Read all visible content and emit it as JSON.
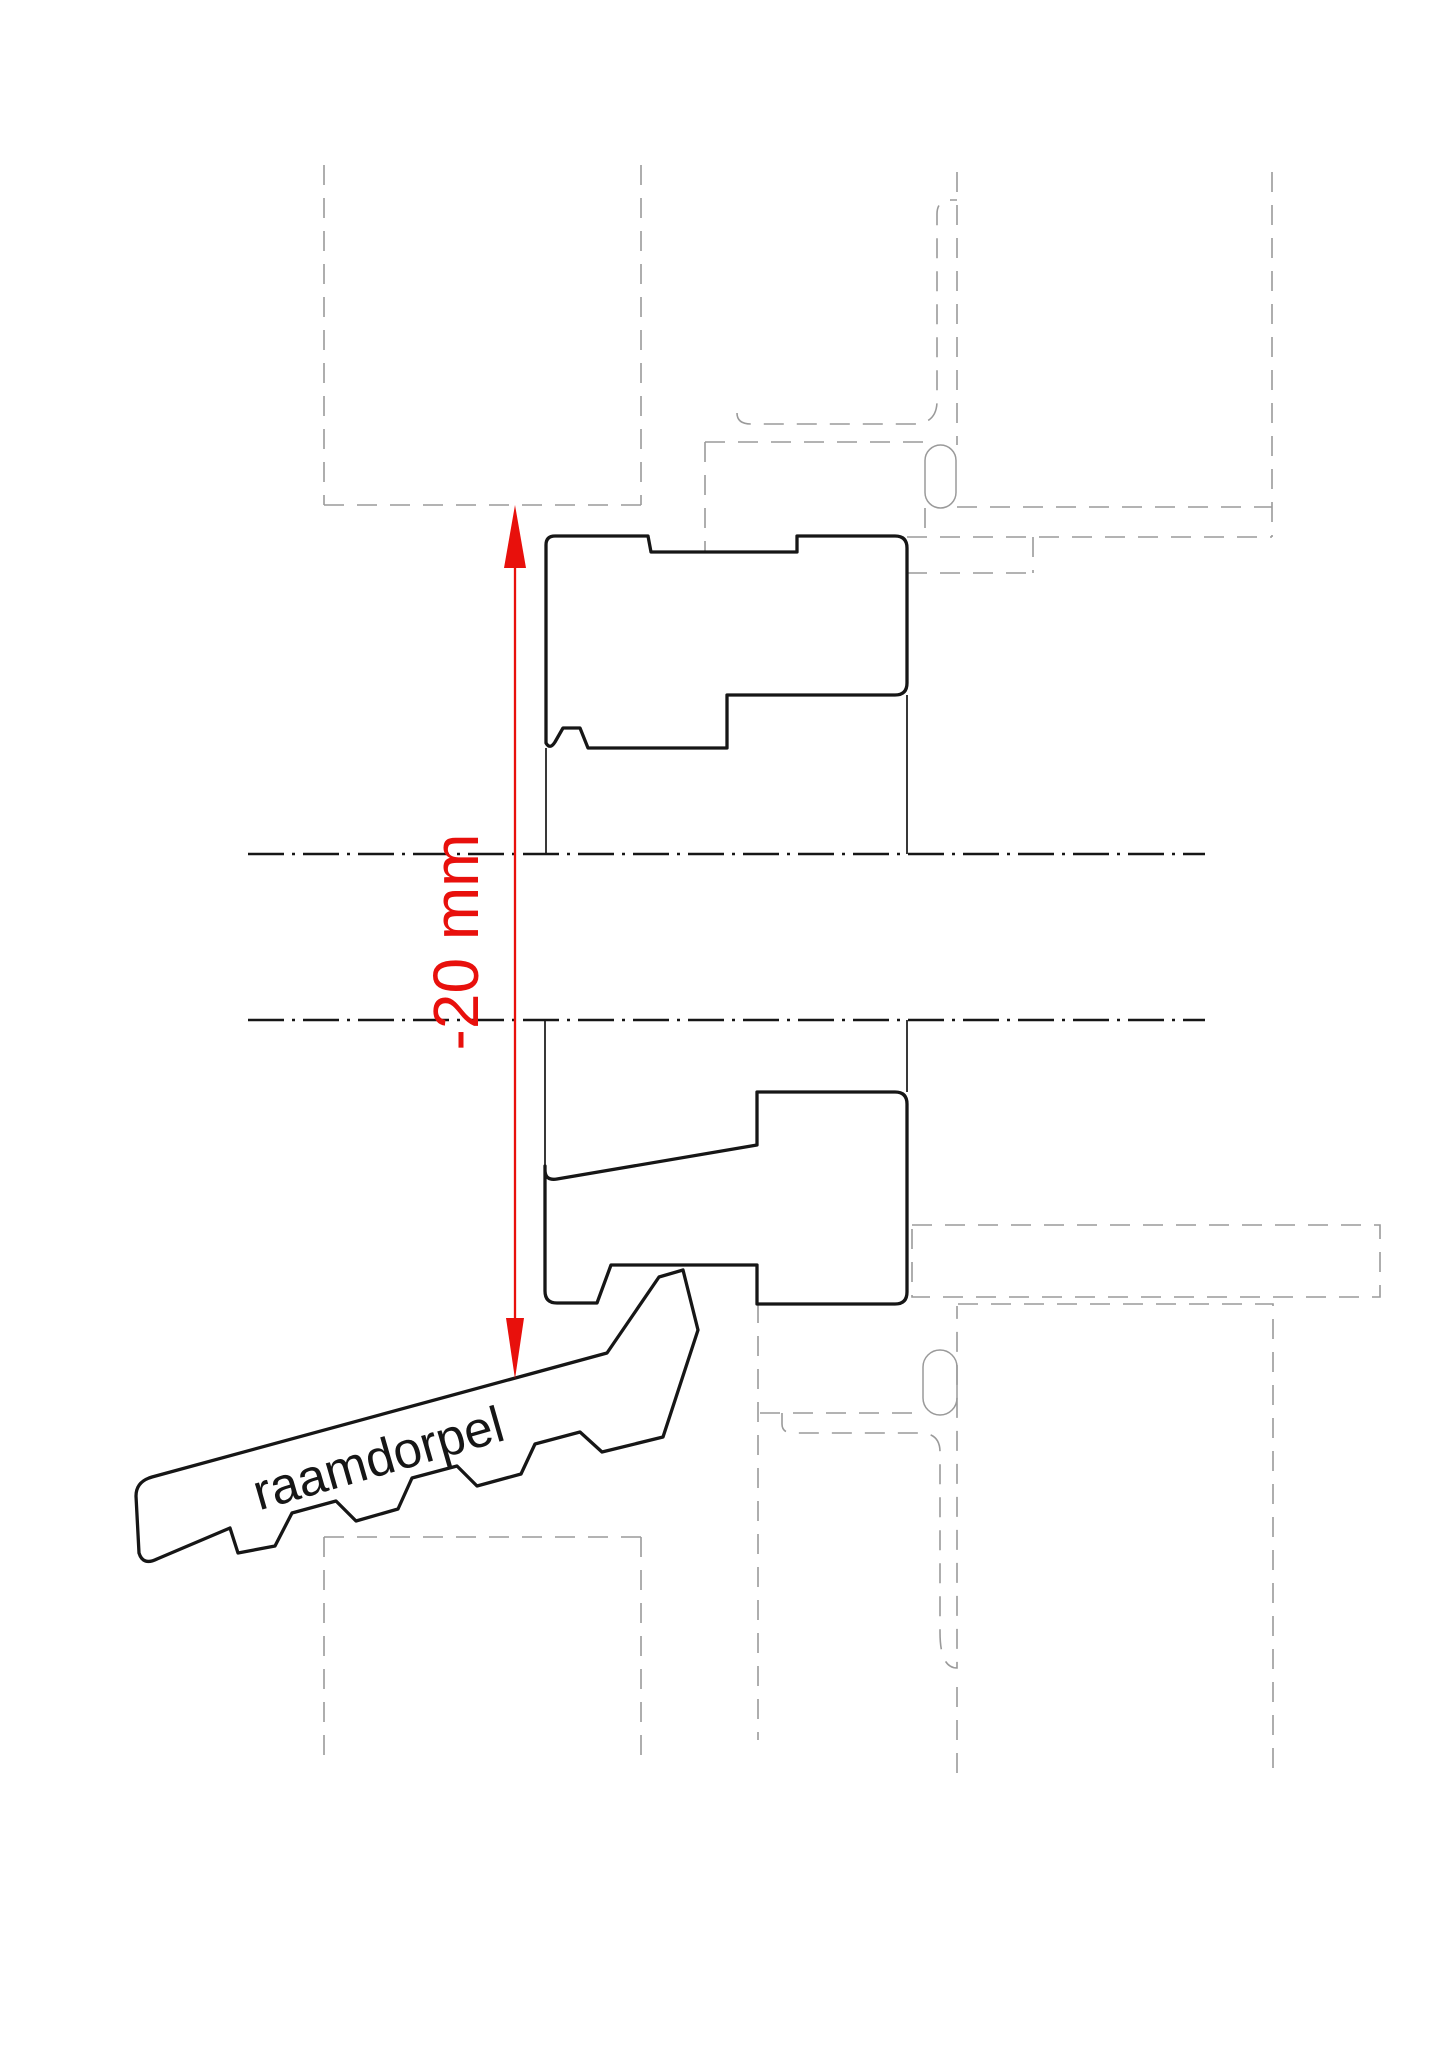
{
  "drawing": {
    "type": "window-sill-connection-detail",
    "labels": {
      "dimension": "-20 mm",
      "sill": "raamdorpel"
    },
    "colors": {
      "dimension": "#e8100c",
      "outline": "#161616",
      "phantom": "#9a9a9a",
      "background": "#ffffff"
    }
  }
}
